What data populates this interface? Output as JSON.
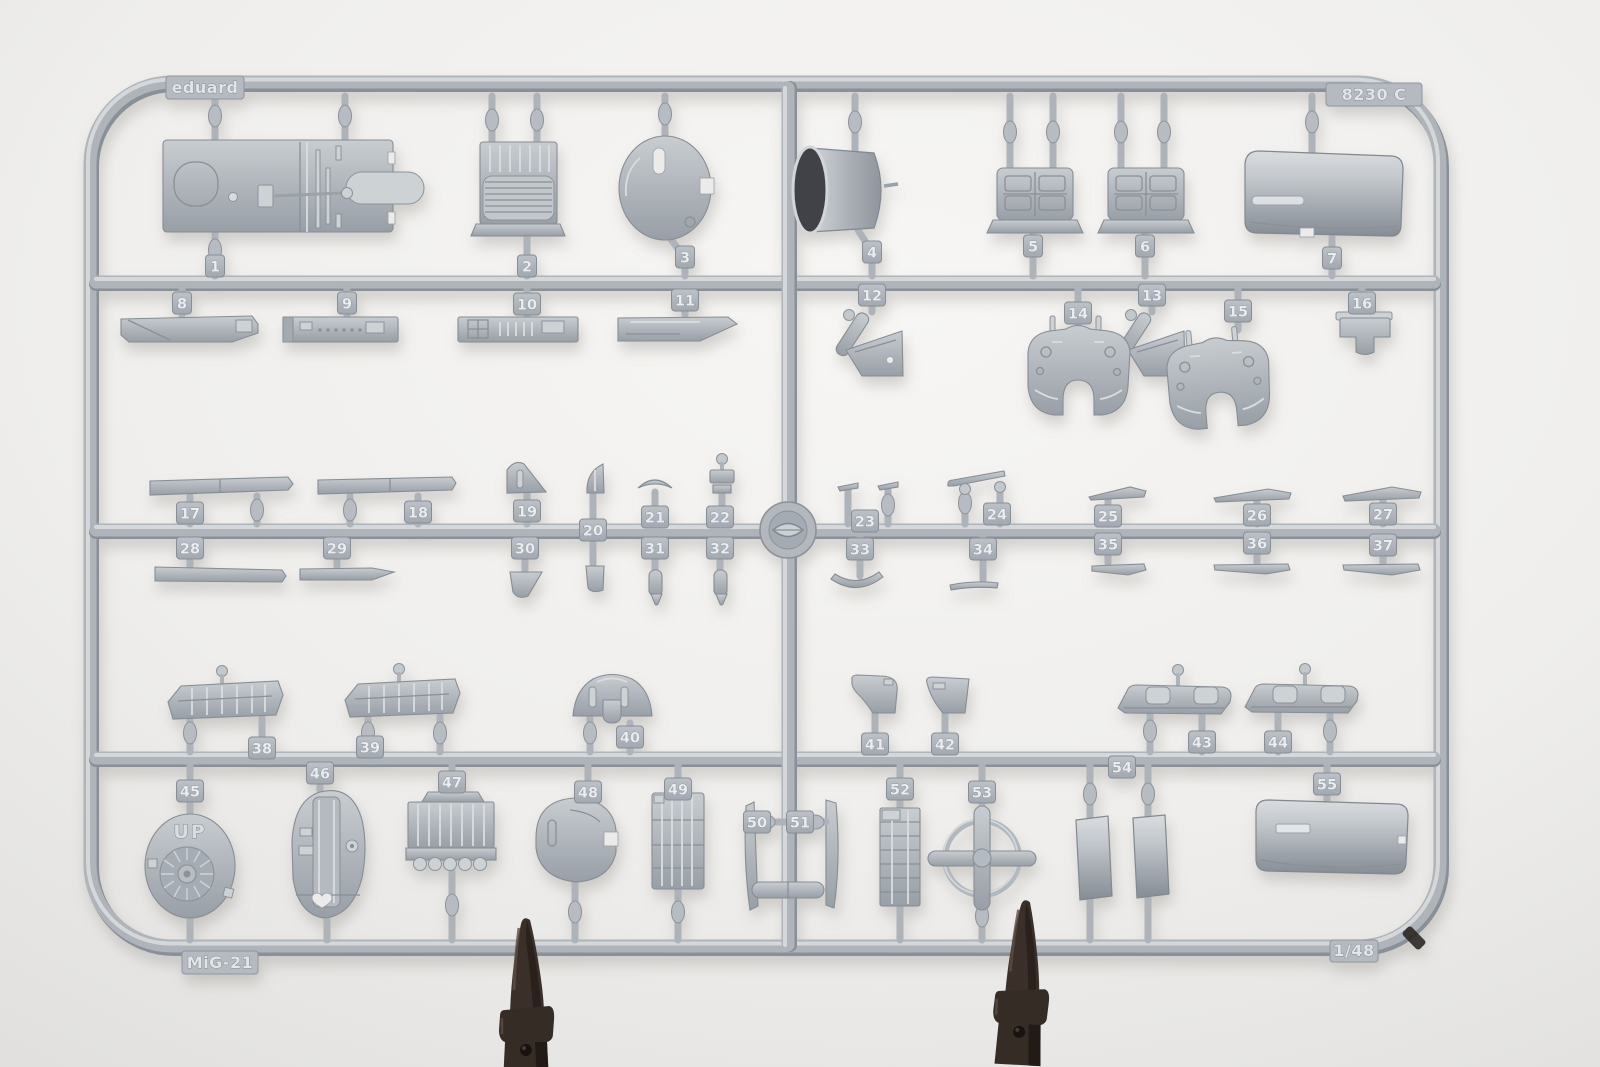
{
  "scene": {
    "type": "photograph",
    "subject": "Light-gray injection-molded plastic model kit sprue with numbered parts, photographed on a white backdrop and held upright by two dark clips",
    "labels": {
      "brand": "eduard",
      "sprue_code": "8230 C",
      "model": "MiG-21",
      "scale": "1/48"
    },
    "part_marking_up": "UP",
    "colors": {
      "background_light": "#f7f6f4",
      "background_shade": "#e2e1df",
      "plastic_base": "#b5bbc1",
      "plastic_highlight": "#d8dcdf",
      "plastic_shadow": "#8a9097",
      "intake_opening": "#3f4247",
      "clip_dark": "#372d27"
    },
    "part_number_tags": [
      {
        "label": "1",
        "x": 215,
        "y": 266
      },
      {
        "label": "2",
        "x": 527,
        "y": 266
      },
      {
        "label": "3",
        "x": 685,
        "y": 257
      },
      {
        "label": "4",
        "x": 872,
        "y": 252
      },
      {
        "label": "5",
        "x": 1033,
        "y": 246
      },
      {
        "label": "6",
        "x": 1145,
        "y": 246
      },
      {
        "label": "7",
        "x": 1332,
        "y": 258
      },
      {
        "label": "8",
        "x": 182,
        "y": 303
      },
      {
        "label": "9",
        "x": 347,
        "y": 303
      },
      {
        "label": "10",
        "x": 527,
        "y": 304
      },
      {
        "label": "11",
        "x": 685,
        "y": 300
      },
      {
        "label": "12",
        "x": 872,
        "y": 295
      },
      {
        "label": "13",
        "x": 1152,
        "y": 295
      },
      {
        "label": "14",
        "x": 1078,
        "y": 313
      },
      {
        "label": "15",
        "x": 1238,
        "y": 311
      },
      {
        "label": "16",
        "x": 1362,
        "y": 303
      },
      {
        "label": "17",
        "x": 190,
        "y": 513
      },
      {
        "label": "18",
        "x": 418,
        "y": 512
      },
      {
        "label": "19",
        "x": 527,
        "y": 511
      },
      {
        "label": "20",
        "x": 593,
        "y": 530
      },
      {
        "label": "21",
        "x": 655,
        "y": 517
      },
      {
        "label": "22",
        "x": 720,
        "y": 517
      },
      {
        "label": "23",
        "x": 865,
        "y": 521
      },
      {
        "label": "24",
        "x": 997,
        "y": 514
      },
      {
        "label": "25",
        "x": 1108,
        "y": 516
      },
      {
        "label": "26",
        "x": 1257,
        "y": 515
      },
      {
        "label": "27",
        "x": 1383,
        "y": 514
      },
      {
        "label": "28",
        "x": 190,
        "y": 548
      },
      {
        "label": "29",
        "x": 337,
        "y": 548
      },
      {
        "label": "30",
        "x": 525,
        "y": 548
      },
      {
        "label": "31",
        "x": 655,
        "y": 548
      },
      {
        "label": "32",
        "x": 720,
        "y": 548
      },
      {
        "label": "33",
        "x": 860,
        "y": 549
      },
      {
        "label": "34",
        "x": 983,
        "y": 549
      },
      {
        "label": "35",
        "x": 1108,
        "y": 544
      },
      {
        "label": "36",
        "x": 1257,
        "y": 543
      },
      {
        "label": "37",
        "x": 1383,
        "y": 545
      },
      {
        "label": "38",
        "x": 262,
        "y": 748
      },
      {
        "label": "39",
        "x": 370,
        "y": 747
      },
      {
        "label": "40",
        "x": 630,
        "y": 737
      },
      {
        "label": "41",
        "x": 875,
        "y": 744
      },
      {
        "label": "42",
        "x": 945,
        "y": 744
      },
      {
        "label": "43",
        "x": 1202,
        "y": 742
      },
      {
        "label": "44",
        "x": 1278,
        "y": 742
      },
      {
        "label": "45",
        "x": 190,
        "y": 791
      },
      {
        "label": "46",
        "x": 320,
        "y": 773
      },
      {
        "label": "47",
        "x": 452,
        "y": 782
      },
      {
        "label": "48",
        "x": 588,
        "y": 792
      },
      {
        "label": "49",
        "x": 678,
        "y": 789
      },
      {
        "label": "50",
        "x": 757,
        "y": 822
      },
      {
        "label": "51",
        "x": 800,
        "y": 822
      },
      {
        "label": "52",
        "x": 900,
        "y": 789
      },
      {
        "label": "53",
        "x": 982,
        "y": 792
      },
      {
        "label": "54",
        "x": 1122,
        "y": 767
      },
      {
        "label": "55",
        "x": 1327,
        "y": 784
      }
    ]
  }
}
